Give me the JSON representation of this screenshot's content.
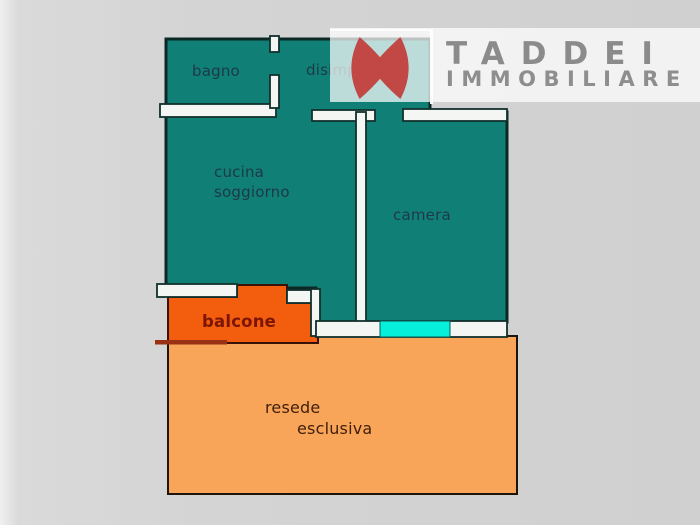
{
  "brand": {
    "name": "TADDEI",
    "subtitle": "IMMOBILIARE",
    "logo": "red-double-blade-H-monogram"
  },
  "plan": {
    "labels": {
      "bagno": "bagno",
      "disimpegno": "disimpegno",
      "cucina": "cucina",
      "soggiorno": "soggiorno",
      "camera": "camera",
      "balcone": "balcone",
      "resede": "resede",
      "esclusiva": "esclusiva"
    }
  },
  "colors": {
    "room_fill": "#108076",
    "wall_fill": "#f3f6f3",
    "outline": "#12302c",
    "balcony_fill": "#f25d0e",
    "balcony_accent": "#9a3114",
    "garden_fill": "#f8a459",
    "window_cyan": "#06efda",
    "label_text": "#1d3948",
    "balcony_text": "#7c1504",
    "garden_text": "#3e1f0a",
    "brand_text": "#8b8b8b",
    "logo_red": "#c23330",
    "background_gray": "#d2d2d2"
  }
}
